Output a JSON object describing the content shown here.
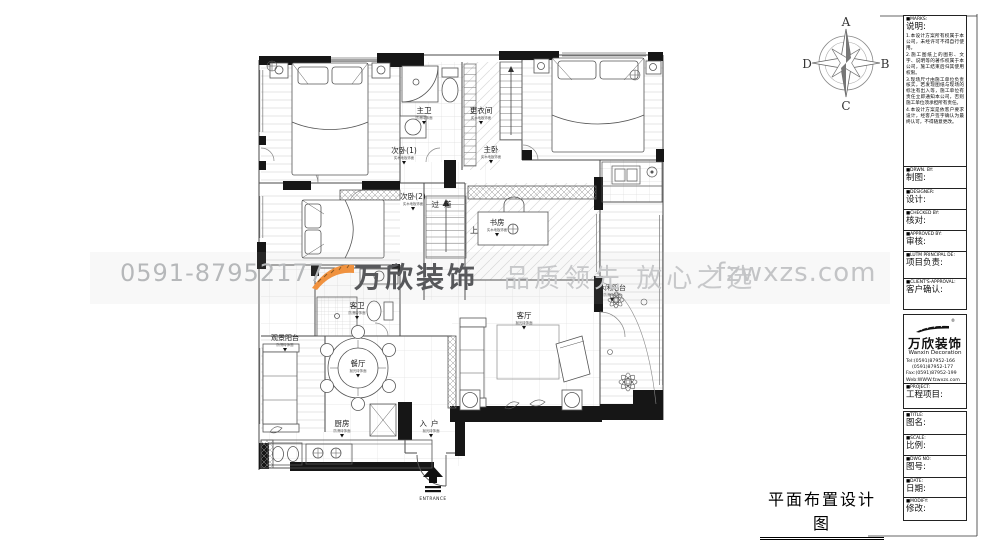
{
  "page": {
    "bottom_title": "平面布置设计图"
  },
  "compass": {
    "n": "A",
    "e": "B",
    "s": "C",
    "w": "D"
  },
  "watermark": {
    "phone": "0591-87952177",
    "logo": "万欣装饰",
    "slogan": "品质领先 放心之选",
    "site": "fzwxzs.com",
    "orange": "#f0923f"
  },
  "titleblock": {
    "marks": {
      "en": "■MARKS:",
      "zh": "说明:",
      "notes": [
        "1.本设计方案所有权属于本公司，未经许可不得自行使用。",
        "2.施工图纸上的图形、文字、说明等的著作权属于本公司，施工结束后归其使用权限。",
        "3.现场尺寸由施工单位负责核实，若发现图纸与现场的标注有出入等，施工单位有责任立即通知本公司，否则施工单位须承担所有责任。",
        "4.本设计方案是依客户要求设计，经客户签字确认为最终认可，不得随意更改。"
      ]
    },
    "drawn": {
      "en": "■DRWN. BY:",
      "zh": "制图:"
    },
    "designer": {
      "en": "■DESIGNER:",
      "zh": "设计:"
    },
    "checked": {
      "en": "■CHECKED BY:",
      "zh": "核对:"
    },
    "approved": {
      "en": "■APPROVED BY:",
      "zh": "审核:"
    },
    "principal": {
      "en": "■LUTM PRINCIPAL DE:",
      "zh": "项目负责:"
    },
    "client": {
      "en": "■CLIENT'S-APPROVAL:",
      "zh": "客户确认:"
    },
    "company": {
      "name": "万欣装饰",
      "reg": "®",
      "en": "Wanxin Decoration",
      "tel1": "Tel:(0591)87952-166",
      "tel2": "    (0591)87952-177",
      "fax": "Fax:(0591)87952-199",
      "web": "Web:WWW.fzwxzs.com"
    },
    "project": {
      "en": "■PROJECT:",
      "zh": "工程项目:"
    },
    "title": {
      "en": "■TITLE:",
      "zh": "图名:"
    },
    "scale": {
      "en": "■SCALE:",
      "zh": "比例:"
    },
    "dwgno": {
      "en": "■DWG NO:",
      "zh": "图号:"
    },
    "date": {
      "en": "■DATE:",
      "zh": "日期:"
    },
    "modify": {
      "en": "■MODIFY:",
      "zh": "修改:"
    }
  },
  "plan": {
    "rooms": [
      {
        "name": "次卧(1)",
        "note": "实木地板饰面"
      },
      {
        "name": "主卫",
        "note": "防滑砖饰面"
      },
      {
        "name": "更衣间",
        "note": "实木地板饰面"
      },
      {
        "name": "主卧",
        "note": "实木地板饰面"
      },
      {
        "name": "次卧(2)",
        "note": "实木地板饰面"
      },
      {
        "name": "过道",
        "note": "抛光砖饰面"
      },
      {
        "name": "书房",
        "note": "实木地板饰面"
      },
      {
        "name": "客卫",
        "note": "防滑砖饰面"
      },
      {
        "name": "休闲阳台",
        "note": "防滑砖饰面"
      },
      {
        "name": "客厅",
        "note": "抛光砖饰面"
      },
      {
        "name": "观景阳台",
        "note": "防滑砖饰面"
      },
      {
        "name": "餐厅",
        "note": "抛光砖饰面"
      },
      {
        "name": "厨房",
        "note": "防滑砖饰面"
      },
      {
        "name": "入户",
        "note": "抛光砖饰面"
      }
    ],
    "stair_label": "上",
    "entrance_label": "ENTRANCE"
  }
}
